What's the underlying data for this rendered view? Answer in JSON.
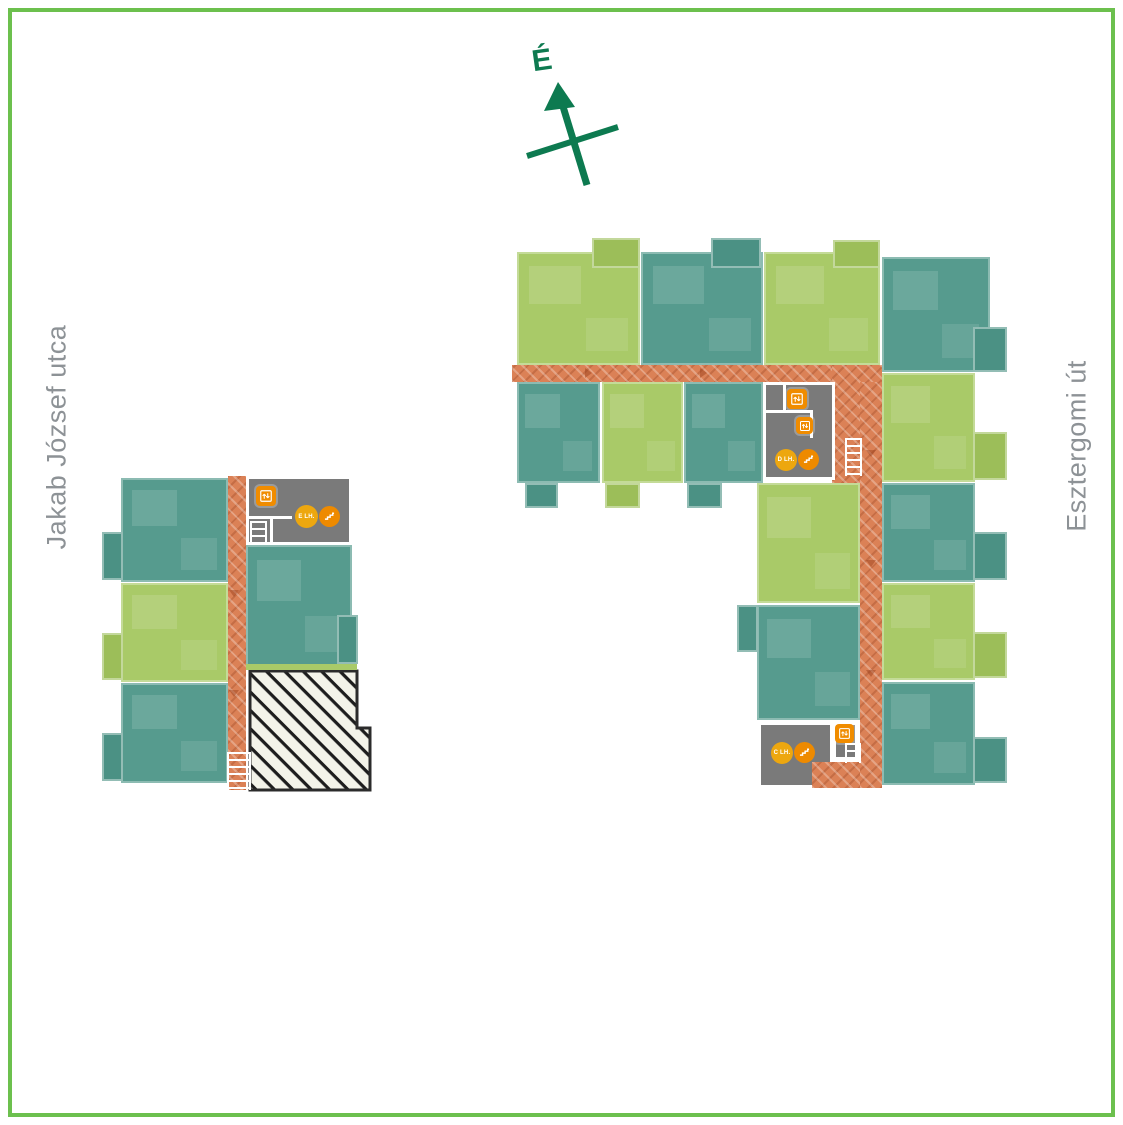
{
  "canvas": {
    "background": "#ffffff",
    "border_color": "#6cc04e"
  },
  "compass": {
    "label": "É",
    "color": "#0d7a50"
  },
  "streets": {
    "left_label": "Jakab József utca",
    "right_label": "Esztergomi út",
    "text_color": "#8d9296"
  },
  "palette": {
    "unit_green": "#a9ca68",
    "unit_teal": "#569b8e",
    "balcony_green": "#9cbe59",
    "balcony_teal": "#4b9184",
    "corridor_orange": "#db8156",
    "core_gray": "#7a7a7a",
    "elevator_icon_orange": "#f08c00",
    "lh_badge_orange": "#eda70f",
    "stairs_badge_orange": "#ee8a00",
    "reserved_fill": "#f3f3e9",
    "reserved_stripe": "#1d1d1d"
  },
  "cores": {
    "e": {
      "label": "E LH."
    },
    "d": {
      "label": "D LH."
    },
    "c": {
      "label": "C LH."
    }
  },
  "inventory": {
    "left_block": {
      "green_units": 1,
      "teal_units": 3,
      "reserved_hatched_units": 1,
      "stair_core": "E"
    },
    "right_block": {
      "green_units": 6,
      "teal_units": 7,
      "stair_cores": [
        "D",
        "C"
      ]
    }
  }
}
